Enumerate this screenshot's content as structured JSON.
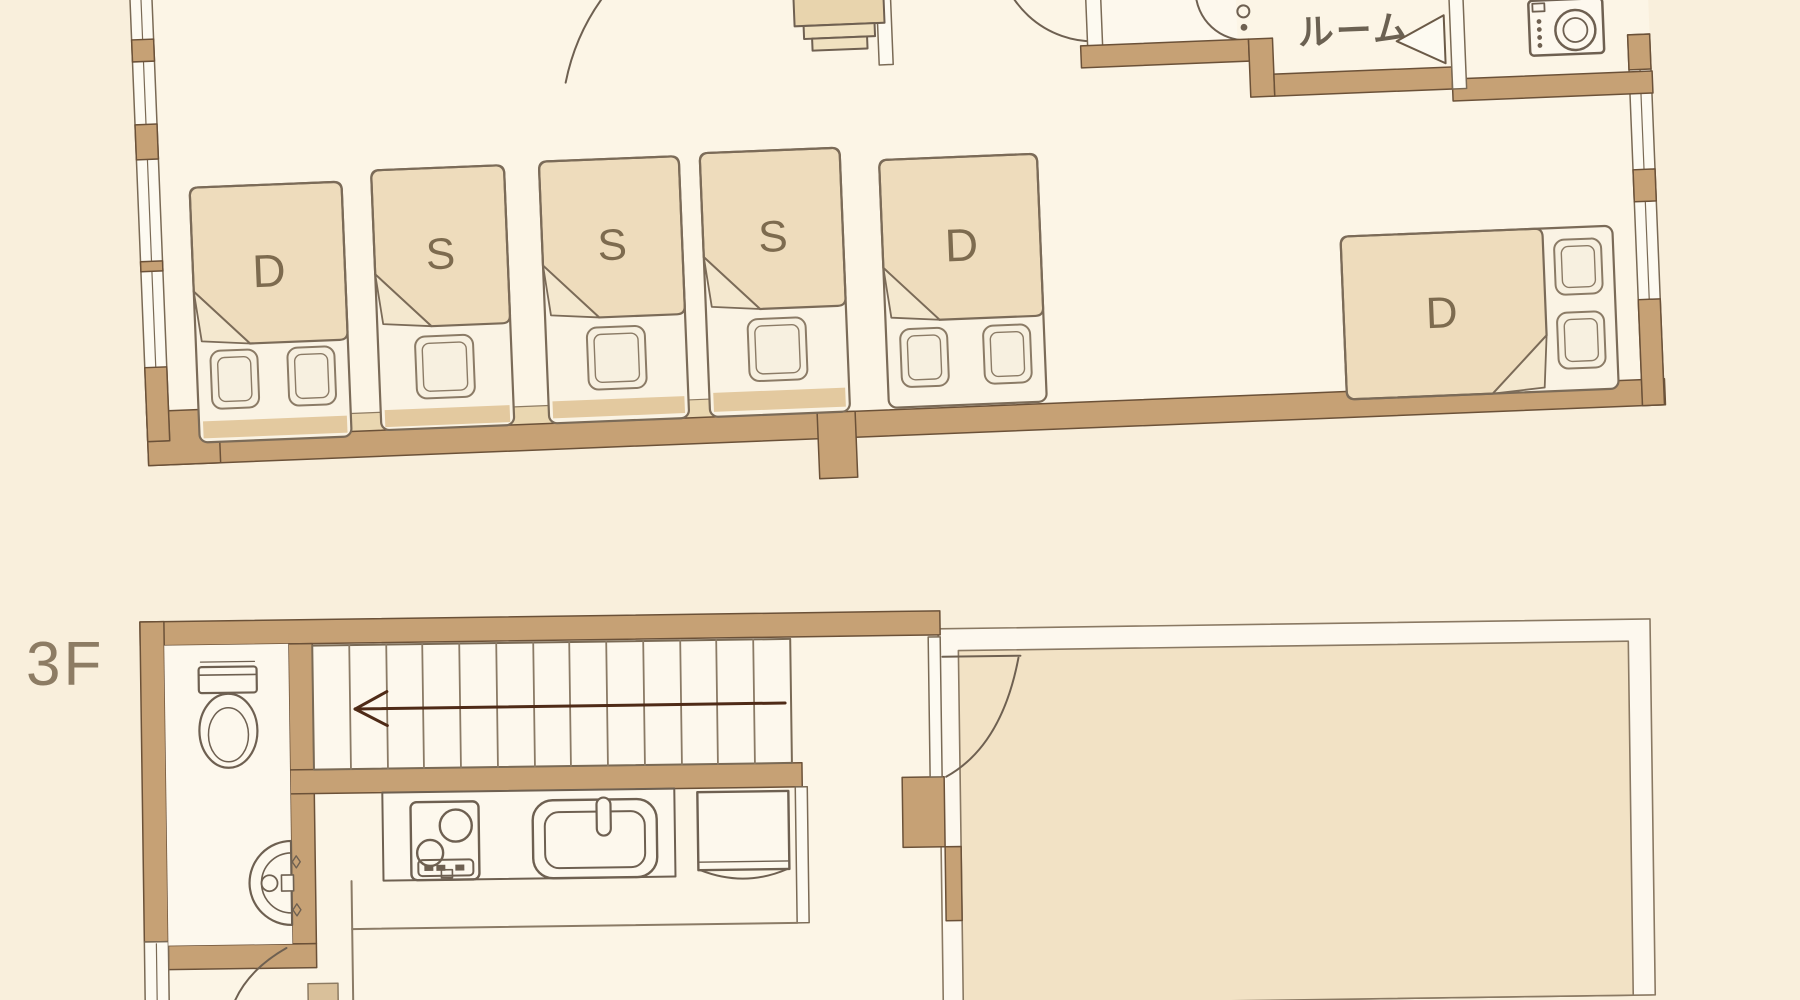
{
  "floor_plan": {
    "floor_label": "3F",
    "utility_room_label": "ルーム",
    "bed_labels": {
      "bed_1": "D",
      "bed_2": "S",
      "bed_3": "S",
      "bed_4": "S",
      "bed_5": "D",
      "bed_6": "D"
    },
    "palette": {
      "background": "#f9efdc",
      "floor": "#fcf5e6",
      "room_white": "#fdf8ed",
      "wall_fill": "#c6a175",
      "wall_outline": "#6b5138",
      "blanket": "#eedcbc",
      "linen": "#faf3e4",
      "headboard": "#e3c99f",
      "big_room_fill": "#f2e2c5",
      "line": "#6e6051",
      "arrow": "#4f2b17",
      "bed_label_text": "#7d6b4f",
      "room_label_text": "#6b6152",
      "floor_label_text": "#8d7c64"
    },
    "icons": [
      "toilet-icon",
      "hand-basin-icon",
      "sink-icon",
      "stove-icon",
      "refrigerator-icon",
      "washing-machine-icon",
      "shower-icon",
      "stairs-icon",
      "door-swing-icon",
      "door-triangle-icon",
      "pillow-icon",
      "chair-icon",
      "window-icon",
      "arrow-left-icon"
    ]
  }
}
